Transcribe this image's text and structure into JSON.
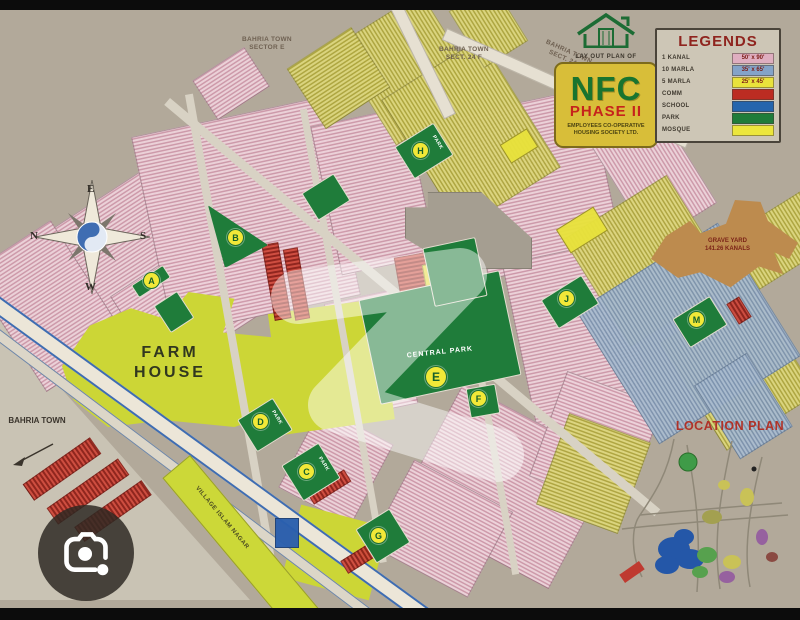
{
  "viewer": {
    "camera_button_icon": "camera-lens-icon"
  },
  "map": {
    "background_color": "#b2a99a",
    "title_sign": {
      "caption": "LAY OUT PLAN OF",
      "name": "NFC",
      "phase": "PHASE II",
      "subtitle_line1": "EMPLOYEES CO-OPERATIVE",
      "subtitle_line2": "HOUSING SOCIETY LTD.",
      "board_color": "#d8be39",
      "name_color": "#19742f",
      "phase_color": "#c6231c"
    },
    "legend": {
      "title": "LEGENDS",
      "title_color": "#8f241e",
      "plot_types": [
        {
          "label": "1 KANAL",
          "size": "50' x 90'",
          "color": "#dfaec0"
        },
        {
          "label": "10 MARLA",
          "size": "35' x 65'",
          "color": "#84a3c8"
        },
        {
          "label": "5 MARLA",
          "size": "25' x 45'",
          "color": "#e9e23b"
        }
      ],
      "zones": [
        {
          "label": "COMM",
          "color": "#bc2c22"
        },
        {
          "label": "SCHOOL",
          "color": "#2565ad"
        },
        {
          "label": "PARK",
          "color": "#1f7c3a"
        },
        {
          "label": "MOSQUE",
          "color": "#ece63c"
        }
      ]
    },
    "compass": {
      "top": "E",
      "right": "S",
      "bottom": "W",
      "left": "N"
    },
    "labels": {
      "farm_house_line1": "FARM",
      "farm_house_line2": "HOUSE",
      "bahria_town": "BAHRIA TOWN",
      "sector_e_line1": "BAHRIA TOWN",
      "sector_e_line2": "SECTOR E",
      "sect_24f_line1": "BAHRIA TOWN",
      "sect_24f_line2": "SECT. 24 F",
      "central_park": "CENTRAL PARK",
      "grave_yard_line1": "GRAVE YARD",
      "grave_yard_line2": "141.26 KANALS",
      "village_road": "VILLAGE ISLAM NAGAR",
      "location_plan": "LOCATION PLAN",
      "park": "PARK"
    },
    "park_markers": [
      "A",
      "B",
      "C",
      "D",
      "E",
      "F",
      "G",
      "H",
      "J",
      "M"
    ]
  }
}
